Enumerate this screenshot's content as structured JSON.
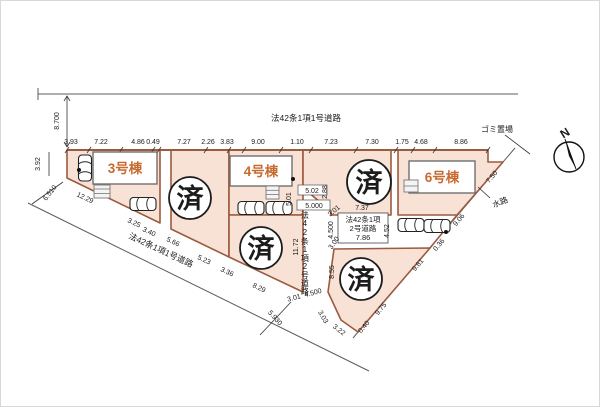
{
  "diagram": {
    "compass_label": "N",
    "roads": {
      "top": "法42条1項1号道路",
      "southwest": "法42条1項1号道路",
      "center_vertical": "法42条1項2号道路",
      "branch": {
        "line1": "法42条1項",
        "line2": "2号道路",
        "width": "7.86"
      }
    },
    "landmarks": {
      "garbage": "ゴミ置場",
      "waterway": "水路"
    },
    "buildings": {
      "b3": "3号棟",
      "b4": "4号棟",
      "b6": "6号棟"
    },
    "sold_label": "済",
    "dims": {
      "top": [
        "3.93",
        "7.22",
        "4.86",
        "0.49",
        "7.27",
        "2.26",
        "3.83",
        "9.00",
        "1.10",
        "7.23",
        "7.30",
        "1.75",
        "4.68",
        "8.86"
      ],
      "west": {
        "height": "8.700",
        "edge": "3.92",
        "diag": "6.510"
      },
      "sw_edge": [
        "12.29",
        "3.25",
        "3.40",
        "5.66",
        "5.23",
        "3.36",
        "8.29"
      ],
      "exit": {
        "a": "3.01",
        "b": "4.500",
        "c": "5.930"
      },
      "center": {
        "w_top": "5.02",
        "n_side": "2.88",
        "lot4_e": "5.01",
        "w_mid": "5.000",
        "cut_n": "3.01",
        "length": "11.72",
        "bend_w": "4.500",
        "cut_s": "3.00",
        "lot_w": "8.55",
        "lot5_s": "7.37",
        "park": "4.52"
      },
      "bottom_lot": [
        "3.03",
        "3.22"
      ],
      "se_edge": [
        "0.40",
        "9.75",
        "9.81",
        "0.36",
        "9.06",
        "7.50"
      ]
    },
    "colors": {
      "lot_fill": "#f8e2d6",
      "lot_stroke": "#9c5a3e",
      "building_label": "#c8692f",
      "ink": "#222222"
    }
  }
}
